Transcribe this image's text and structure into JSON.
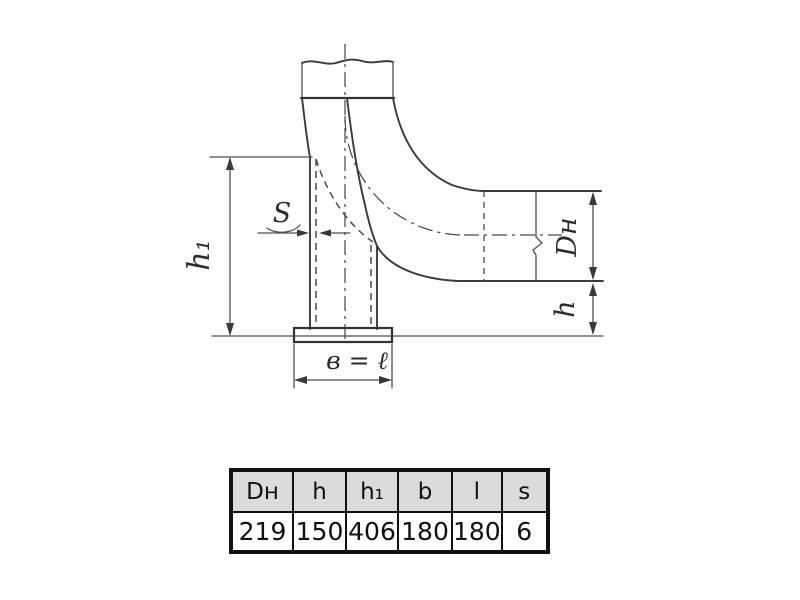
{
  "drawing": {
    "labels": {
      "wall_thickness": "S",
      "height_h1": "h₁",
      "diameter": "Dн",
      "height_h": "h",
      "base_width": "в = ℓ"
    }
  },
  "table": {
    "columns": [
      {
        "label": "Dн",
        "value": "219"
      },
      {
        "label": "h",
        "value": "150"
      },
      {
        "label": "h₁",
        "value": "406"
      },
      {
        "label": "b",
        "value": "180"
      },
      {
        "label": "l",
        "value": "180"
      },
      {
        "label": "s",
        "value": "6"
      }
    ]
  }
}
